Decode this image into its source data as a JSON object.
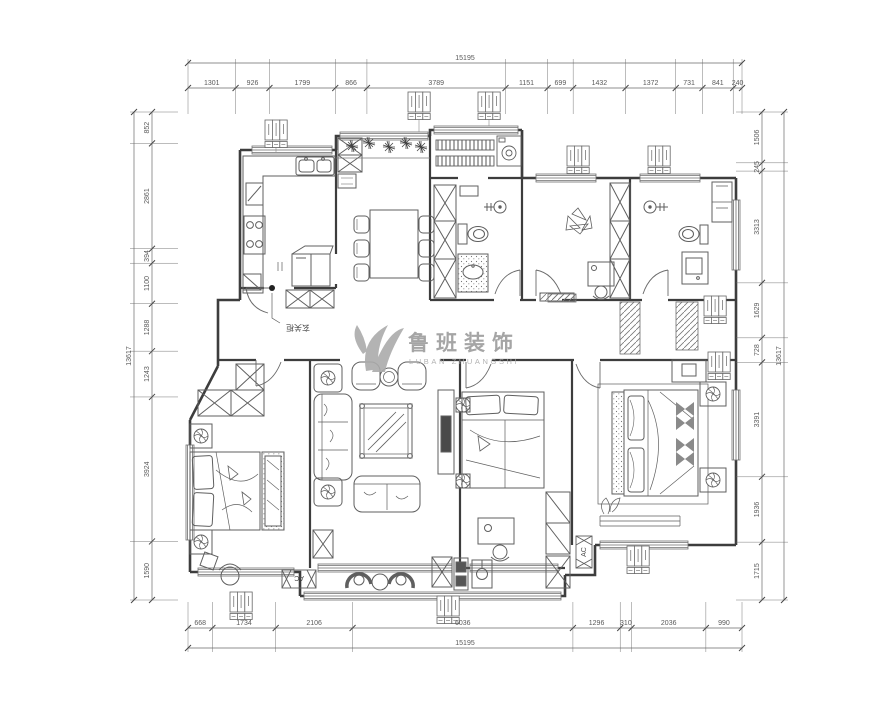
{
  "watermark": {
    "title_cn": "鲁班装饰",
    "subtitle_en": "LUBAN ZHUANGSHI"
  },
  "plan_labels": {
    "entry_cabinet": "玄关柜",
    "ac": "AC"
  },
  "dimensions": {
    "top": {
      "total": "15195",
      "segments": [
        "1301",
        "926",
        "1799",
        "866",
        "3789",
        "1151",
        "699",
        "1432",
        "1372",
        "731",
        "841",
        "240"
      ]
    },
    "bottom": {
      "total": "15195",
      "segments": [
        "668",
        "1734",
        "2106",
        "6036",
        "1296",
        "310",
        "2036",
        "990"
      ]
    },
    "left": {
      "total": "13617",
      "segments": [
        "852",
        "2861",
        "394",
        "1100",
        "1288",
        "1243",
        "3924",
        "1590"
      ]
    },
    "right": {
      "total": "13617",
      "segments": [
        "1506",
        "245",
        "3313",
        "1629",
        "728",
        "3391",
        "1936",
        "1715"
      ]
    }
  },
  "colors": {
    "wall": "#3d3d3d",
    "furniture": "#5f5f5f",
    "thin": "#777777",
    "dim": "#6a6a6a",
    "watermark": "#a6a6a6"
  }
}
